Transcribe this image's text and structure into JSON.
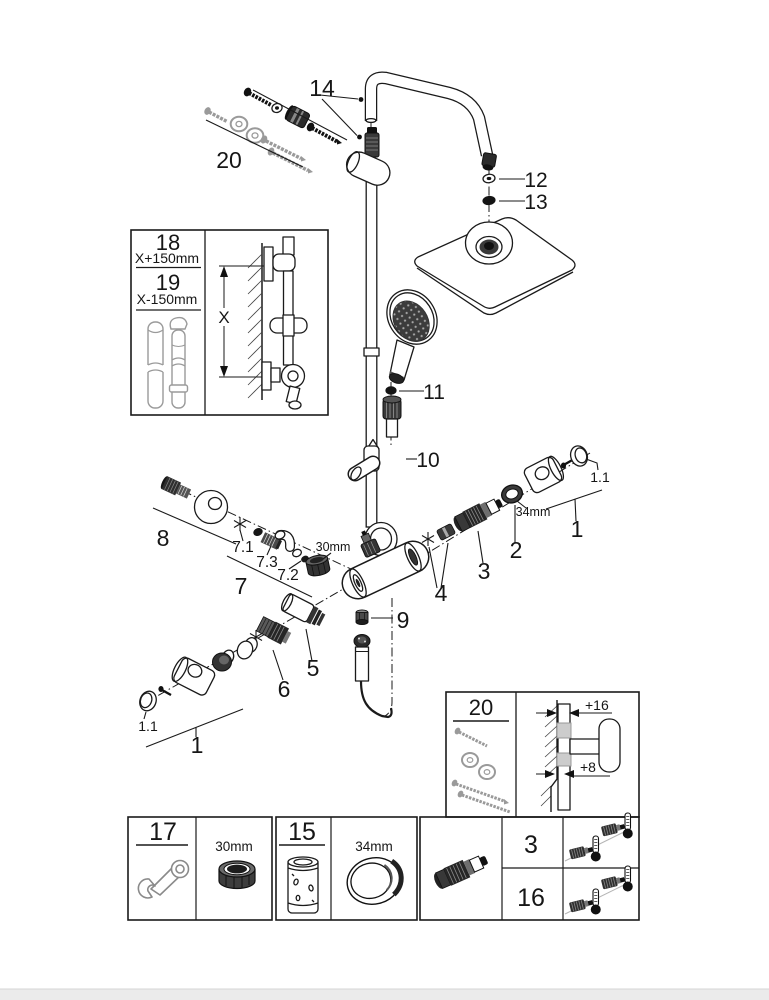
{
  "callouts": {
    "c14": "14",
    "c20_top": "20",
    "c12": "12",
    "c13": "13",
    "c11": "11",
    "c10": "10",
    "c8": "8",
    "c7_1": "7.1",
    "c7_3": "7.3",
    "c7_2": "7.2",
    "c7": "7",
    "c30mm": "30mm",
    "c4": "4",
    "c3": "3",
    "c2": "2",
    "c34mm": "34mm",
    "c1_right": "1",
    "c1_1_right": "1.1",
    "c9": "9",
    "c5": "5",
    "c6": "6",
    "c1_left": "1",
    "c1_1_left": "1.1"
  },
  "inset_rail_length": {
    "n18": "18",
    "dim18": "X+150mm",
    "n19": "19",
    "dim19": "X-150mm",
    "x_dim": "X"
  },
  "inset_mount_depth": {
    "n20": "20",
    "offset_top": "+16",
    "offset_bottom": "+8"
  },
  "tools_table": {
    "wrench_no": "17",
    "wrench_size": "30mm",
    "sleeve_no": "15",
    "sleeve_size": "34mm",
    "variant_a": "3",
    "variant_b": "16"
  },
  "colors": {
    "line": "#1a1a1a",
    "gray_part": "#9a9a9a",
    "paper": "#ffffff"
  }
}
